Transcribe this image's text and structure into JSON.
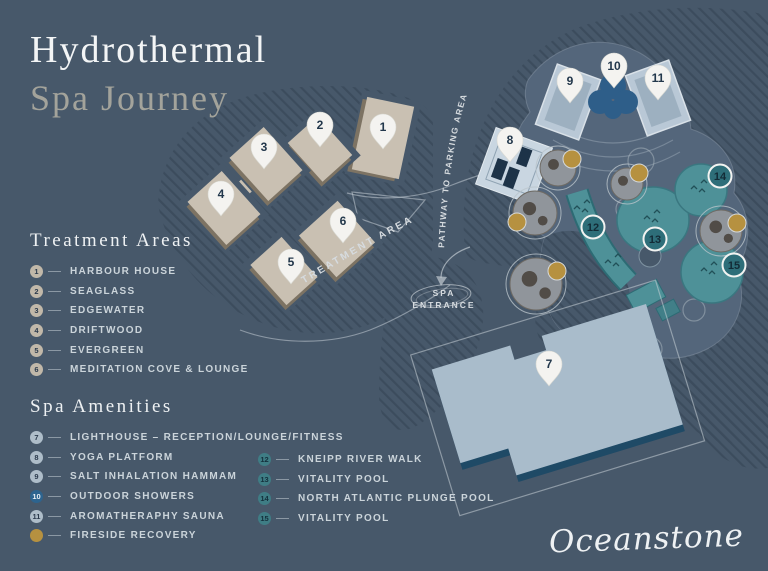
{
  "title": {
    "line1": "Hydrothermal",
    "line2": "Spa Journey"
  },
  "brand": {
    "logo_text": "Oceanstone"
  },
  "map": {
    "labels": {
      "treatment_area": "TREATMENT AREA",
      "pathway": "PATHWAY TO PARKING AREA",
      "entrance_line1": "SPA",
      "entrance_line2": "ENTRANCE"
    },
    "pins": [
      {
        "n": "1",
        "x": 383,
        "y": 130
      },
      {
        "n": "2",
        "x": 320,
        "y": 128
      },
      {
        "n": "3",
        "x": 264,
        "y": 150
      },
      {
        "n": "4",
        "x": 221,
        "y": 197
      },
      {
        "n": "5",
        "x": 291,
        "y": 265
      },
      {
        "n": "6",
        "x": 343,
        "y": 224
      },
      {
        "n": "7",
        "x": 549,
        "y": 367
      },
      {
        "n": "8",
        "x": 510,
        "y": 143
      },
      {
        "n": "9",
        "x": 570,
        "y": 84
      },
      {
        "n": "10",
        "x": 614,
        "y": 69
      },
      {
        "n": "11",
        "x": 658,
        "y": 81
      }
    ],
    "badges": [
      {
        "n": "12",
        "x": 593,
        "y": 227
      },
      {
        "n": "13",
        "x": 655,
        "y": 239
      },
      {
        "n": "14",
        "x": 720,
        "y": 176
      },
      {
        "n": "15",
        "x": 734,
        "y": 265
      }
    ]
  },
  "legend_treatment": {
    "heading": "Treatment Areas",
    "items": [
      {
        "num": "1",
        "label": "HARBOUR HOUSE",
        "style": "tan"
      },
      {
        "num": "2",
        "label": "SEAGLASS",
        "style": "tan"
      },
      {
        "num": "3",
        "label": "EDGEWATER",
        "style": "tan"
      },
      {
        "num": "4",
        "label": "DRIFTWOOD",
        "style": "tan"
      },
      {
        "num": "5",
        "label": "EVERGREEN",
        "style": "tan"
      },
      {
        "num": "6",
        "label": "MEDITATION COVE & LOUNGE",
        "style": "tan"
      }
    ]
  },
  "legend_amenities": {
    "heading": "Spa Amenities",
    "col1": [
      {
        "num": "7",
        "label": "LIGHTHOUSE – RECEPTION/LOUNGE/FITNESS",
        "style": "gray"
      },
      {
        "num": "8",
        "label": "YOGA PLATFORM",
        "style": "gray"
      },
      {
        "num": "9",
        "label": "SALT INHALATION HAMMAM",
        "style": "gray"
      },
      {
        "num": "10",
        "label": "OUTDOOR SHOWERS",
        "style": "blue"
      },
      {
        "num": "11",
        "label": "AROMATHERAPHY SAUNA",
        "style": "gray"
      },
      {
        "num": "",
        "label": "FIRESIDE RECOVERY",
        "style": "gold"
      }
    ],
    "col2": [
      {
        "num": "12",
        "label": "KNEIPP RIVER WALK",
        "style": "teal"
      },
      {
        "num": "13",
        "label": "VITALITY POOL",
        "style": "teal"
      },
      {
        "num": "14",
        "label": "NORTH ATLANTIC PLUNGE POOL",
        "style": "teal"
      },
      {
        "num": "15",
        "label": "VITALITY POOL",
        "style": "teal"
      }
    ]
  },
  "palette": {
    "background": "#47586a",
    "hatch_line": "#3c4c5d",
    "building_tan": "#c9c0b2",
    "building_shadow": "#7d7363",
    "platform": "#54667b",
    "pool_teal": "#4e9198",
    "pool_teal_dark": "#2d6b74",
    "sauna_light": "#b9c8d6",
    "shower_blue": "#2e5e89",
    "lighthouse_light": "#a9bccb",
    "lighthouse_shadow": "#1f4a66",
    "fireside_gold": "#b69140",
    "pin_white": "#f4f3f0",
    "pin_number": "#22374b",
    "legend_text": "#cbd4da",
    "title_white": "#f3f5f6",
    "title_muted": "#a3a39b"
  }
}
